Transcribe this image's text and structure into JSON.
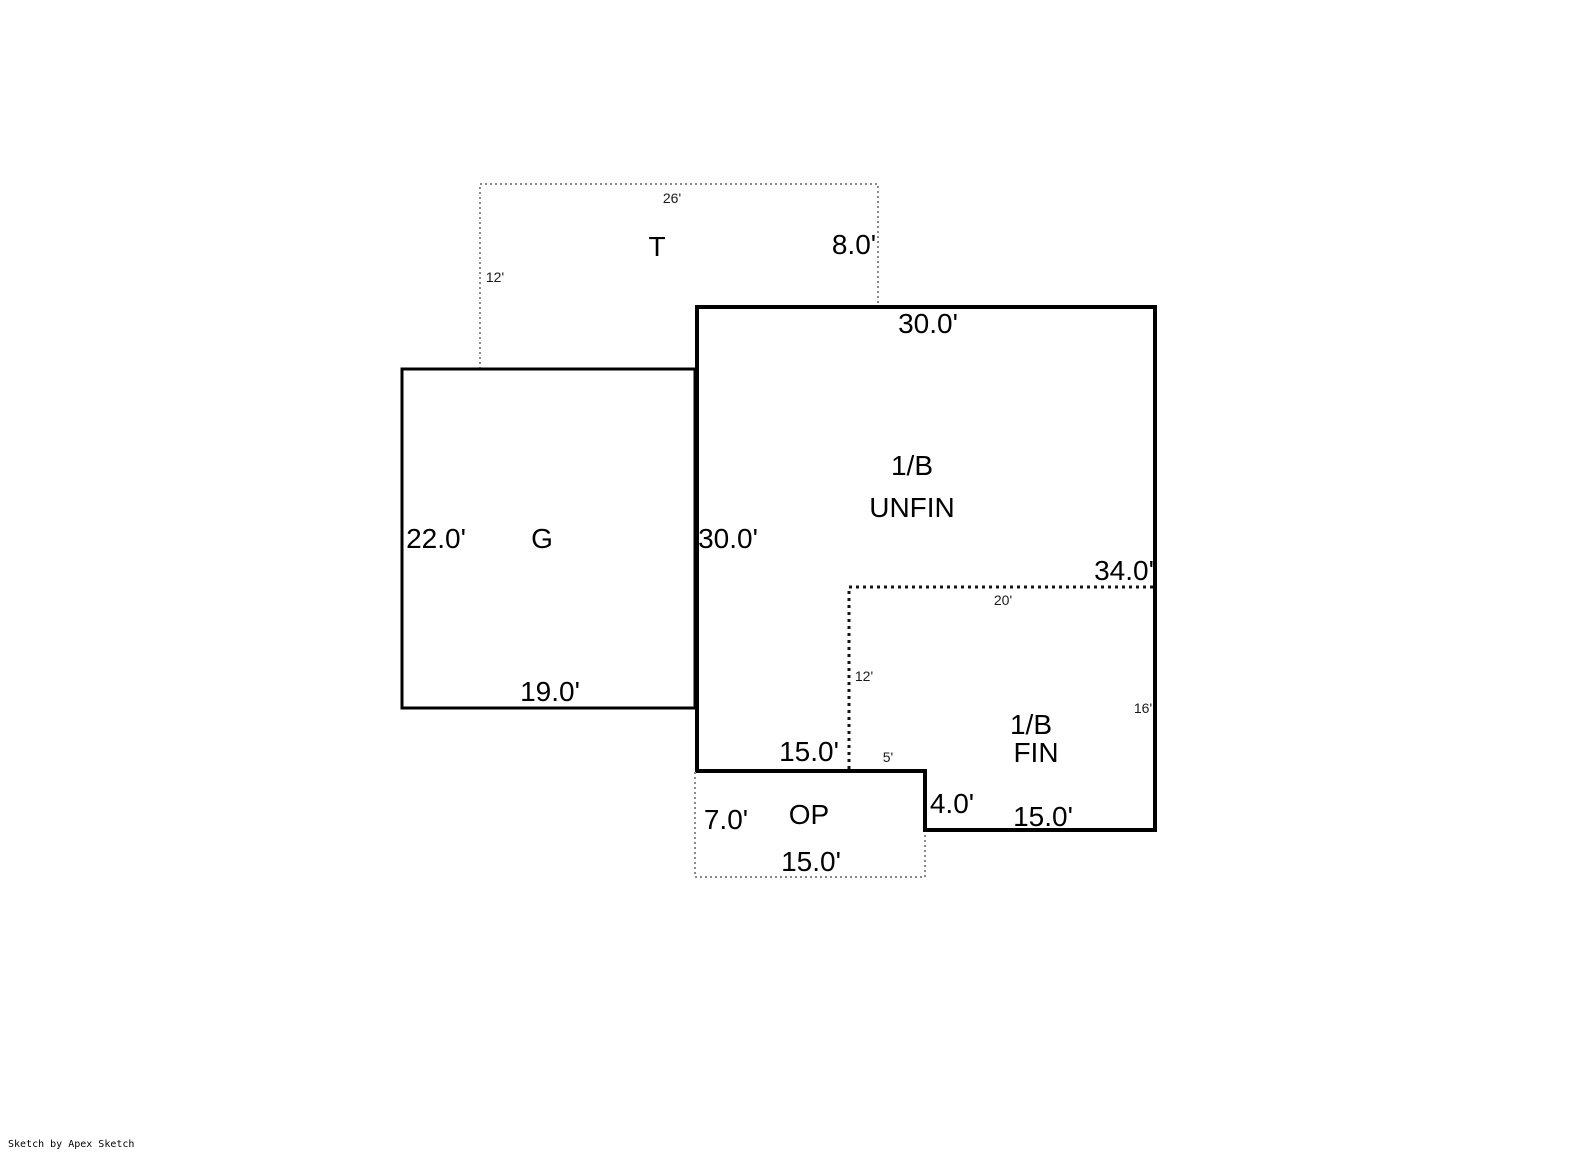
{
  "canvas": {
    "width": 1585,
    "height": 1163,
    "background": "#ffffff"
  },
  "watermark": {
    "text": "Sketch by Apex Sketch"
  },
  "colors": {
    "wall_solid": "#000000",
    "dotted_gray": "#8a8a8a",
    "dotted_black": "#141414",
    "label_text": "#000000"
  },
  "rooms": {
    "tank": {
      "name": "T",
      "dims": {
        "top": "26'",
        "left": "12'",
        "right": "8.0'"
      }
    },
    "garage": {
      "name": "G",
      "dims": {
        "left": "22.0'",
        "bottom": "19.0'"
      }
    },
    "basement_unfinished": {
      "name_line1": "1/B",
      "name_line2": "UNFIN",
      "dims": {
        "top": "30.0'",
        "left": "30.0'",
        "bottom": "15.0'"
      }
    },
    "basement_finished": {
      "name_line1": "1/B",
      "name_line2": "FIN",
      "dims": {
        "right_total": "34.0'",
        "inner_top": "20'",
        "inner_left": "12'",
        "right": "16'",
        "gap": "5'",
        "step": "4.0'",
        "bottom": "15.0'"
      }
    },
    "open_porch": {
      "name": "OP",
      "dims": {
        "left": "7.0'",
        "bottom": "15.0'"
      }
    }
  }
}
